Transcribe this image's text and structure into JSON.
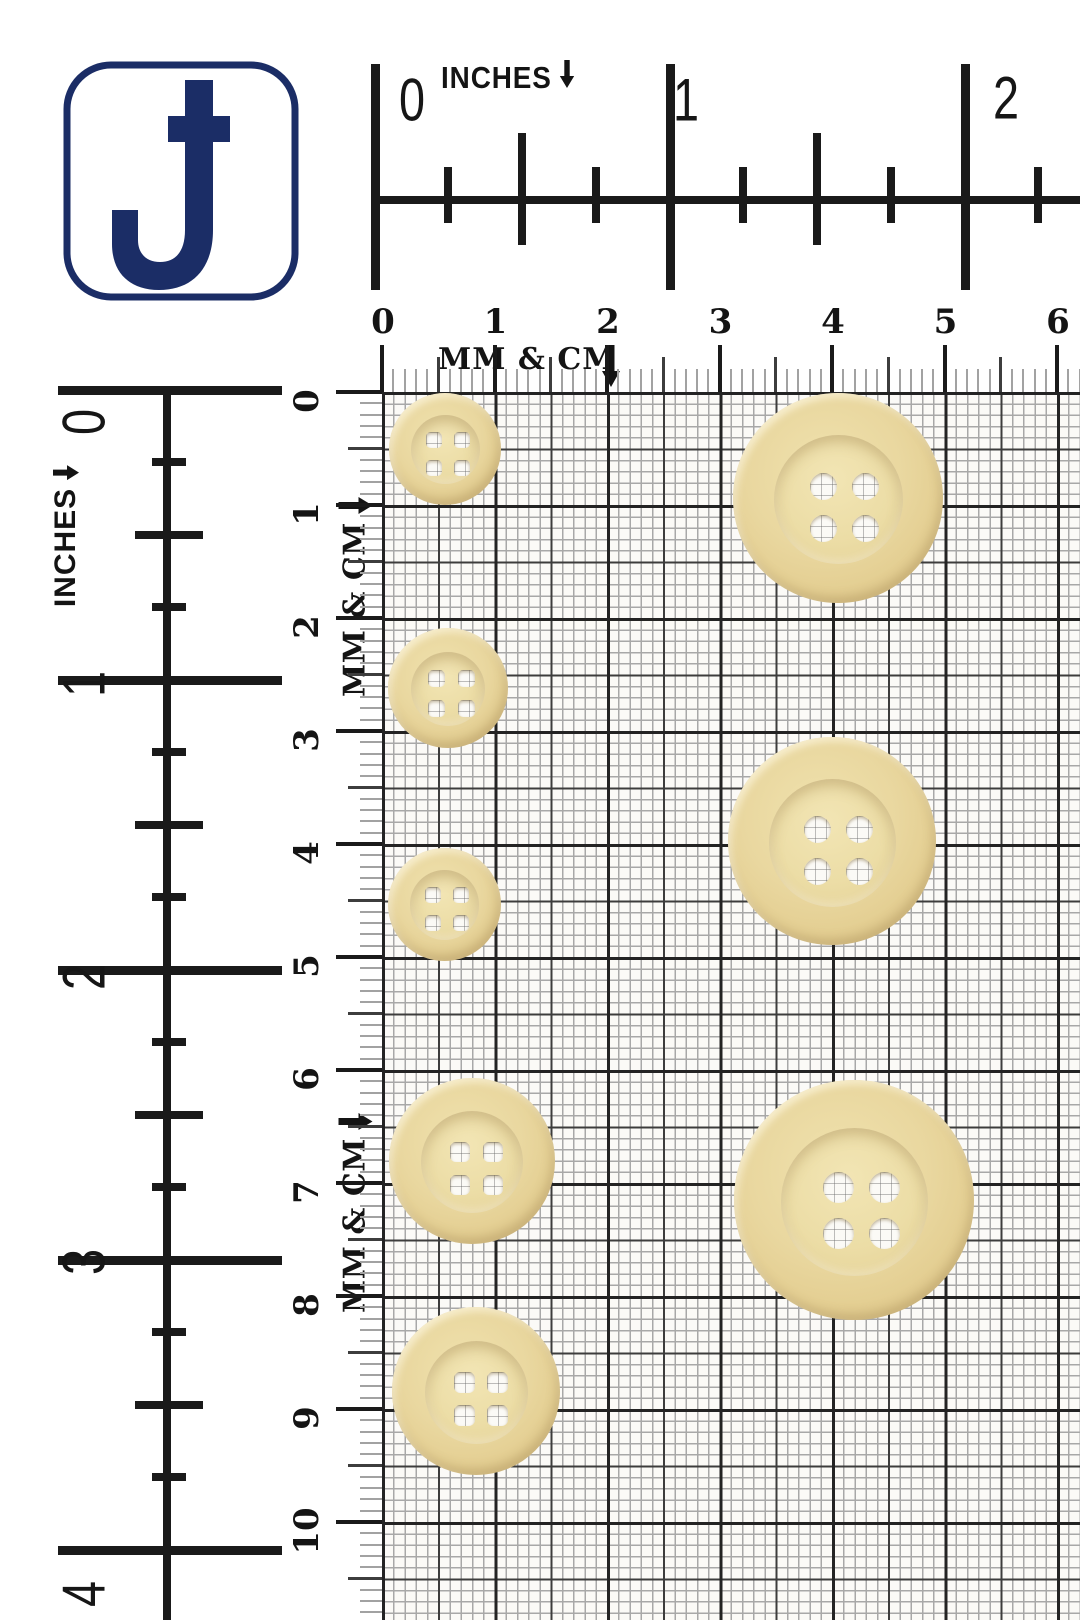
{
  "logo": {
    "glyph": "J"
  },
  "rulers": {
    "top_inches": {
      "label": "INCHES",
      "numbers": [
        "0",
        "1",
        "2"
      ]
    },
    "left_inches": {
      "label": "INCHES",
      "numbers": [
        "0",
        "1",
        "2",
        "3",
        "4"
      ]
    },
    "top_metric": {
      "label": "MM & CM",
      "numbers": [
        "0",
        "1",
        "2",
        "3",
        "4",
        "5",
        "6"
      ]
    },
    "left_metric": {
      "labels": [
        "MM & CM",
        "MM & CM"
      ],
      "numbers": [
        "0",
        "1",
        "2",
        "3",
        "4",
        "5",
        "6",
        "7",
        "8",
        "9",
        "10"
      ]
    }
  },
  "buttons": {
    "hole_count": 4,
    "style": {
      "body_color": "#e8d59d",
      "rim_highlight": "#f3e7ba",
      "rim_shadow": "#cdb376",
      "hole_color": "#fbfaf6"
    },
    "items": [
      {
        "name": "small-button-1",
        "cx": 445,
        "cy": 449,
        "d": 112,
        "hole_d": 16,
        "hole_gap": 28,
        "hole_shape": "rounded-square"
      },
      {
        "name": "small-button-2",
        "cx": 448,
        "cy": 688,
        "d": 120,
        "hole_d": 17,
        "hole_gap": 30,
        "hole_shape": "rounded-square"
      },
      {
        "name": "small-button-3",
        "cx": 444,
        "cy": 904,
        "d": 113,
        "hole_d": 16,
        "hole_gap": 28,
        "hole_shape": "rounded-square"
      },
      {
        "name": "medium-button-1",
        "cx": 472,
        "cy": 1161,
        "d": 166,
        "hole_d": 20,
        "hole_gap": 33,
        "hole_shape": "rounded-square"
      },
      {
        "name": "medium-button-2",
        "cx": 476,
        "cy": 1391,
        "d": 168,
        "hole_d": 21,
        "hole_gap": 33,
        "hole_shape": "rounded-square"
      },
      {
        "name": "large-button-1",
        "cx": 838,
        "cy": 498,
        "d": 210,
        "hole_d": 27,
        "hole_gap": 42,
        "hole_shape": "circle"
      },
      {
        "name": "large-button-2",
        "cx": 832,
        "cy": 841,
        "d": 208,
        "hole_d": 27,
        "hole_gap": 42,
        "hole_shape": "circle"
      },
      {
        "name": "large-button-3",
        "cx": 854,
        "cy": 1200,
        "d": 240,
        "hole_d": 31,
        "hole_gap": 46,
        "hole_shape": "circle"
      }
    ]
  },
  "colors": {
    "ink": "#1a1a1a",
    "navy": "#1b2d66",
    "grid_cm": "#232323",
    "grid_5mm": "#3d3d3d",
    "grid_mm": "#a8a8a8",
    "paper": "#fbfaf7"
  }
}
